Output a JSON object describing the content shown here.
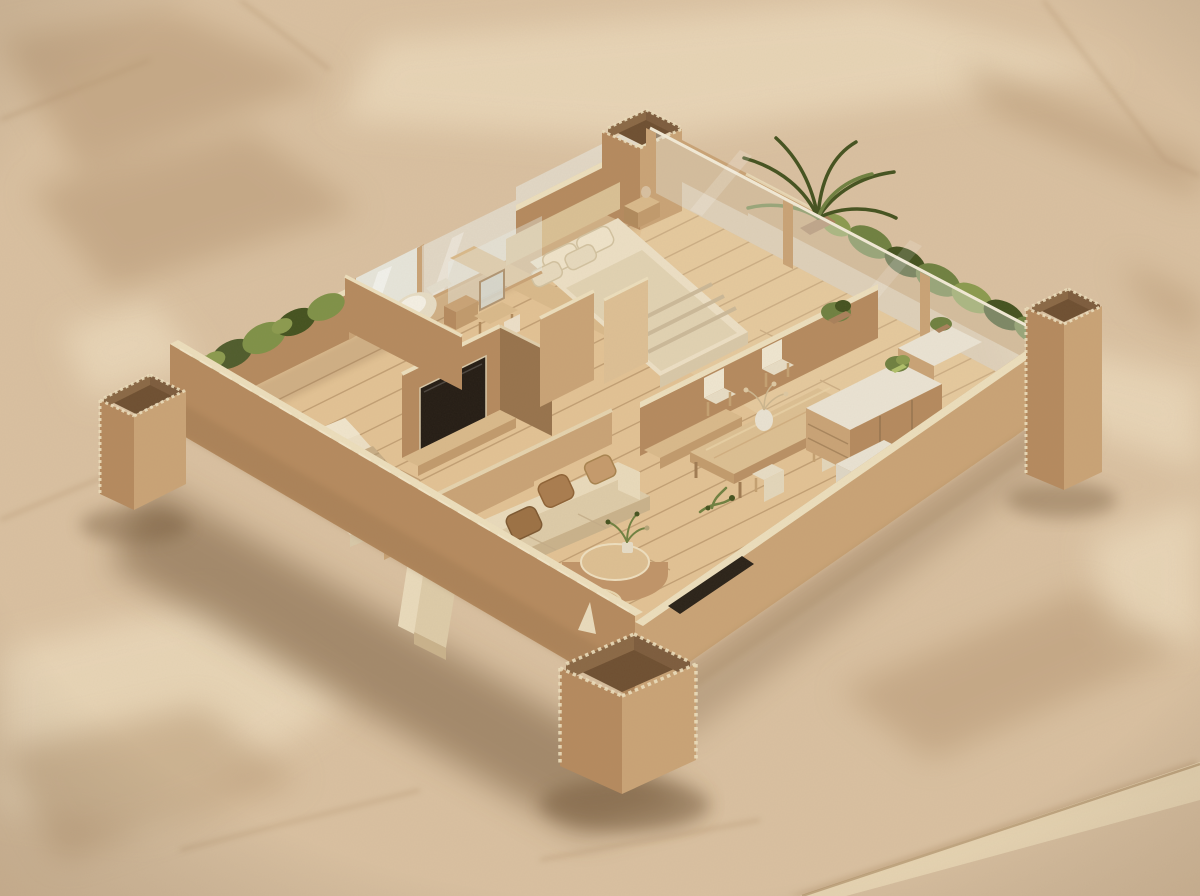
{
  "meta": {
    "kind": "photograph",
    "subject": "isometric cardboard architectural model of an apartment floor plan",
    "surface": "crumpled kraft paper sheet",
    "view": "three-quarter aerial isometric",
    "lighting": "soft warm daylight from upper right"
  },
  "palette": {
    "paper": "#d9c0a0",
    "paperLight": "#eeddbf",
    "paperDark": "#b2936e",
    "foldLight": "#ead8b6",
    "cardboard": "#b58a5e",
    "cardboardLight": "#c9a376",
    "cardboardDark": "#97734c",
    "cardboardEdge": "#ecdebc",
    "corrugInner": "#6e4f31",
    "innerFaceA": "#8a6845",
    "innerFaceB": "#7d5c3d",
    "floorWood": "#e2c294",
    "floorSeam": "#a8845a",
    "benchWood": "#d9b98a",
    "glass": "#e9ede9",
    "mattress": "#ecdfc4",
    "duvet": "#e1d2b2",
    "burlap": "#c7ad85",
    "pillowCream": "#efe3c9",
    "pillowBrown": "#a97c4e",
    "pillowTan": "#c59a6b",
    "sofaCream": "#ddcba8",
    "sofaBack": "#e9dabb",
    "sofaFront": "#c9b28b",
    "screenDark": "#241c14",
    "toilet": "#e6dcc4",
    "counterTop": "#eae3d3",
    "sinkSteel": "#b5b0a2",
    "cooktop": "#8b8578",
    "plantGreen": "#6f8040",
    "plantDark": "#44521f",
    "plantLight": "#8b9a4e",
    "moss": "#7f9147",
    "mossDark": "#4f5c2c",
    "potClay": "#a9805a",
    "shadow": "#6e5236"
  },
  "scene": {
    "background": {
      "material": "crumpled kraft paper",
      "creases": "diagonal facet creases, fold across bottom-right corner"
    },
    "model": {
      "materials": [
        "cardboard walls with cream cut edges",
        "corrugated board corner columns",
        "popsicle-stick wood plank flooring",
        "acrylic glass panes",
        "preserved moss and dried plants"
      ],
      "structure": [
        "four open corrugated corner columns",
        "tall exterior walls on the two front sides",
        "glass balcony wall on the upper-right side",
        "moss planter with window on the upper-left side"
      ],
      "rooms": [
        {
          "name": "master-bedroom",
          "items": [
            "double bed with layered duvet",
            "four pillows",
            "bedside table with small vase",
            "low headboard wall",
            "glass clerestory strip",
            "wood-capped ledge"
          ]
        },
        {
          "name": "bathroom",
          "items": [
            "toilet",
            "vanity with mirror",
            "chair",
            "glass partition",
            "storage cabinet"
          ]
        },
        {
          "name": "media-wall",
          "items": [
            "flat tv with dark screen",
            "cardboard alcove",
            "wood base shelf",
            "closet panels"
          ]
        },
        {
          "name": "second-bedroom",
          "items": [
            "bed with woven burlap throw",
            "wood foot bench",
            "low divider ledge"
          ]
        },
        {
          "name": "living-room",
          "items": [
            "long sofa with chaise",
            "four cushions",
            "two round nesting coffee tables",
            "potted plant on table"
          ]
        },
        {
          "name": "dining-area",
          "items": [
            "wood dining table",
            "four cream chairs",
            "vase with dried flowers",
            "freestanding partition wall with bench"
          ]
        },
        {
          "name": "kitchen",
          "items": [
            "island with drawers",
            "white countertop with double sink",
            "cooktop with two burners",
            "fridge block",
            "small potted plants",
            "loose green sprig on floor"
          ]
        },
        {
          "name": "balcony-garden",
          "items": [
            "cardboard planter trough",
            "dense ferns",
            "potted palm",
            "glass wall with posts"
          ]
        }
      ]
    }
  }
}
